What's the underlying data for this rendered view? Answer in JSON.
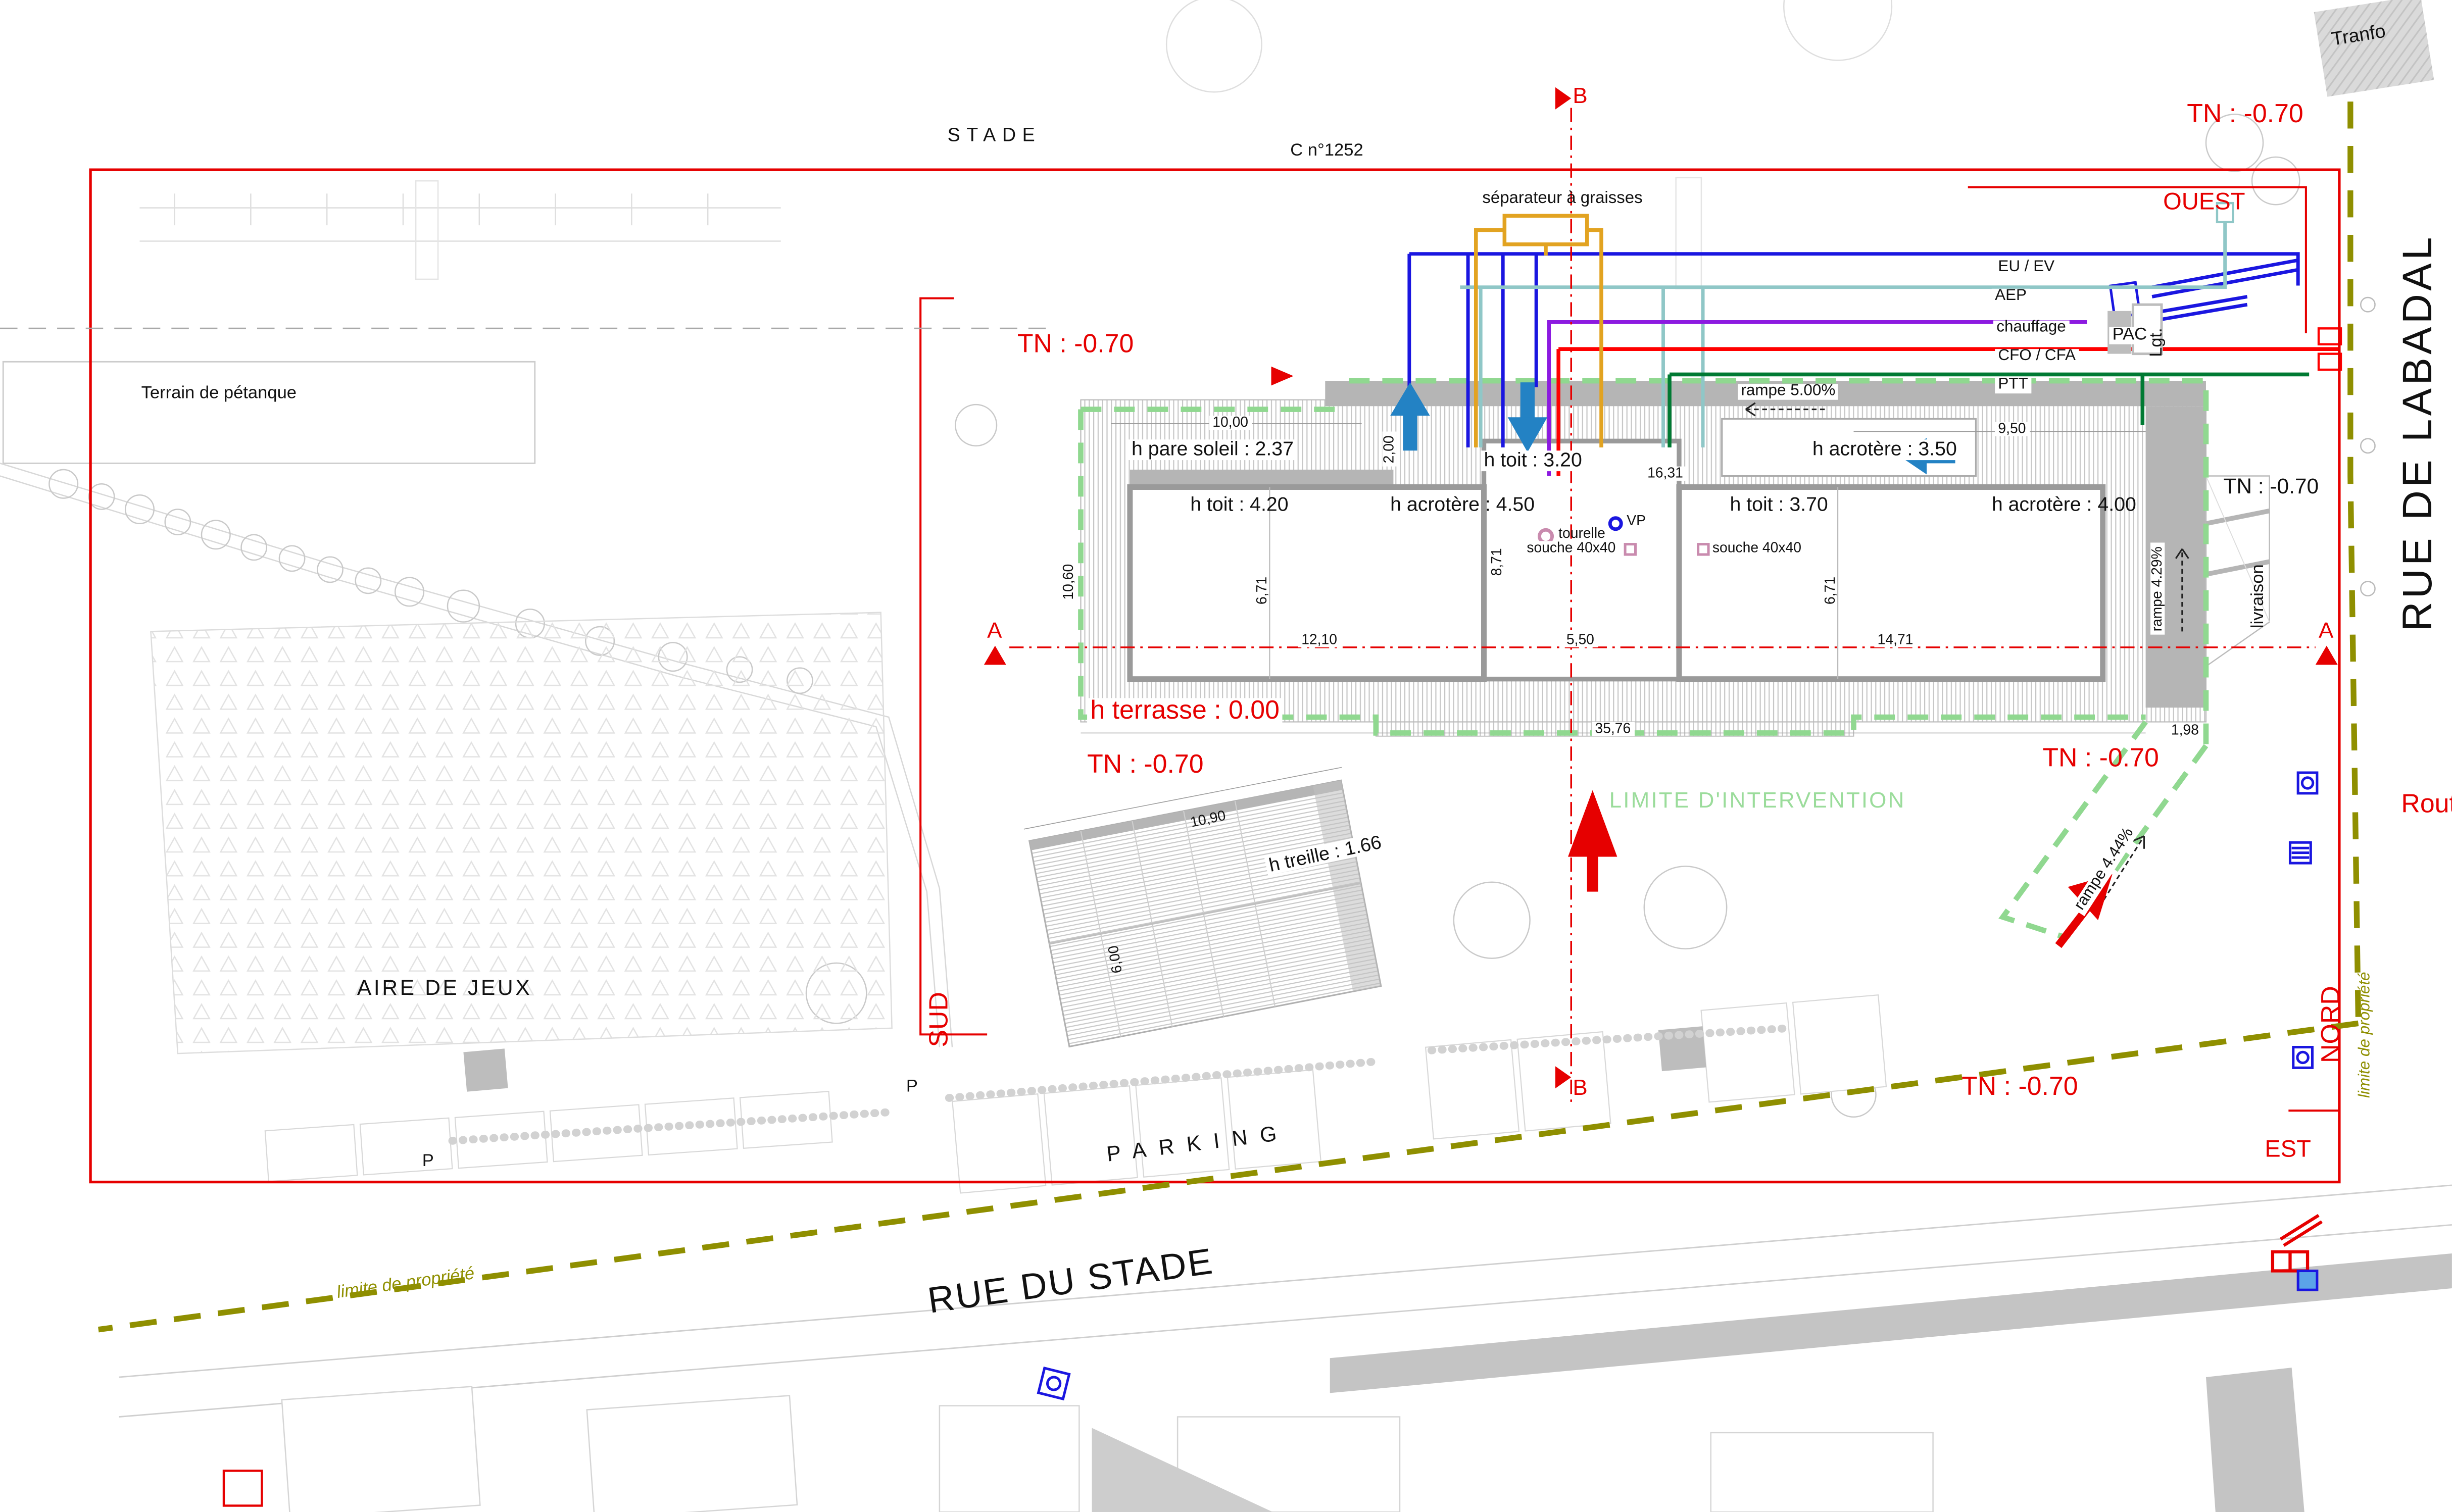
{
  "streets": {
    "rue_du_stade": "RUE DU STADE",
    "rue_de_labadal": "RUE DE LABADAL",
    "route": "Route"
  },
  "areas": {
    "stade": "STADE",
    "parcel": "C n°1252",
    "terrain_petanque": "Terrain de pétanque",
    "aire_de_jeux": "AIRE DE JEUX",
    "parking": "PARKING",
    "parking_p": "P",
    "tranfo": "Tranfo"
  },
  "orientation": {
    "ouest": "OUEST",
    "est": "EST",
    "sud": "SUD",
    "nord": "NORD"
  },
  "levels": {
    "tn": "TN : -0.70",
    "terrasse": "h terrasse : 0.00"
  },
  "sections": {
    "a": "A",
    "b": "B"
  },
  "utilities": {
    "separateur": "séparateur à graisses",
    "eu_ev": "EU / EV",
    "aep": "AEP",
    "chauffage": "chauffage",
    "cfo_cfa": "CFO / CFA",
    "ptt": "PTT",
    "pac": "PAC",
    "lgt": "Lgt."
  },
  "building": {
    "h_pare_soleil": "h pare soleil : 2.37",
    "h_toit_320": "h toit : 3.20",
    "h_acrotere_350": "h acrotère : 3.50",
    "h_toit_420": "h toit : 4.20",
    "h_acrotere_450": "h acrotère : 4.50",
    "h_toit_370": "h toit : 3.70",
    "h_acrotere_400": "h acrotère : 4.00",
    "h_treille": "h treille : 1.66",
    "tourelle": "tourelle",
    "vp": "VP",
    "souche": "souche 40x40",
    "livraison": "livraison"
  },
  "ramps": {
    "rampe_500": "rampe 5.00%",
    "rampe_429": "rampe 4.29%",
    "rampe_444": "rampe 4.44%"
  },
  "limits": {
    "intervention": "LIMITE D'INTERVENTION",
    "propriete": "limite de propriété"
  },
  "dimensions": {
    "d10_00": "10,00",
    "d2_00": "2,00",
    "d16_31": "16,31",
    "d9_50": "9,50",
    "d10_60": "10,60",
    "d6_71": "6,71",
    "d8_71": "8,71",
    "d12_10": "12,10",
    "d5_50": "5,50",
    "d14_71": "14,71",
    "d35_76": "35,76",
    "d1_98": "1,98",
    "d10_90": "10,90",
    "d6_00": "6,00"
  },
  "colors": {
    "boundary_red": "#e60000",
    "limite_propriete_olive": "#8f8f00",
    "limite_intervention_green": "#90d890",
    "eu_ev_blue": "#1a16e0",
    "aep_teal": "#8fc7c7",
    "chauffage_purple": "#8c1ae0",
    "cfo_cfa_red": "#ff0000",
    "ptt_green": "#007a33",
    "separateur_orange": "#e2a321",
    "flow_arrow_blue": "#2382c4",
    "souche_pink": "#c98bae"
  }
}
